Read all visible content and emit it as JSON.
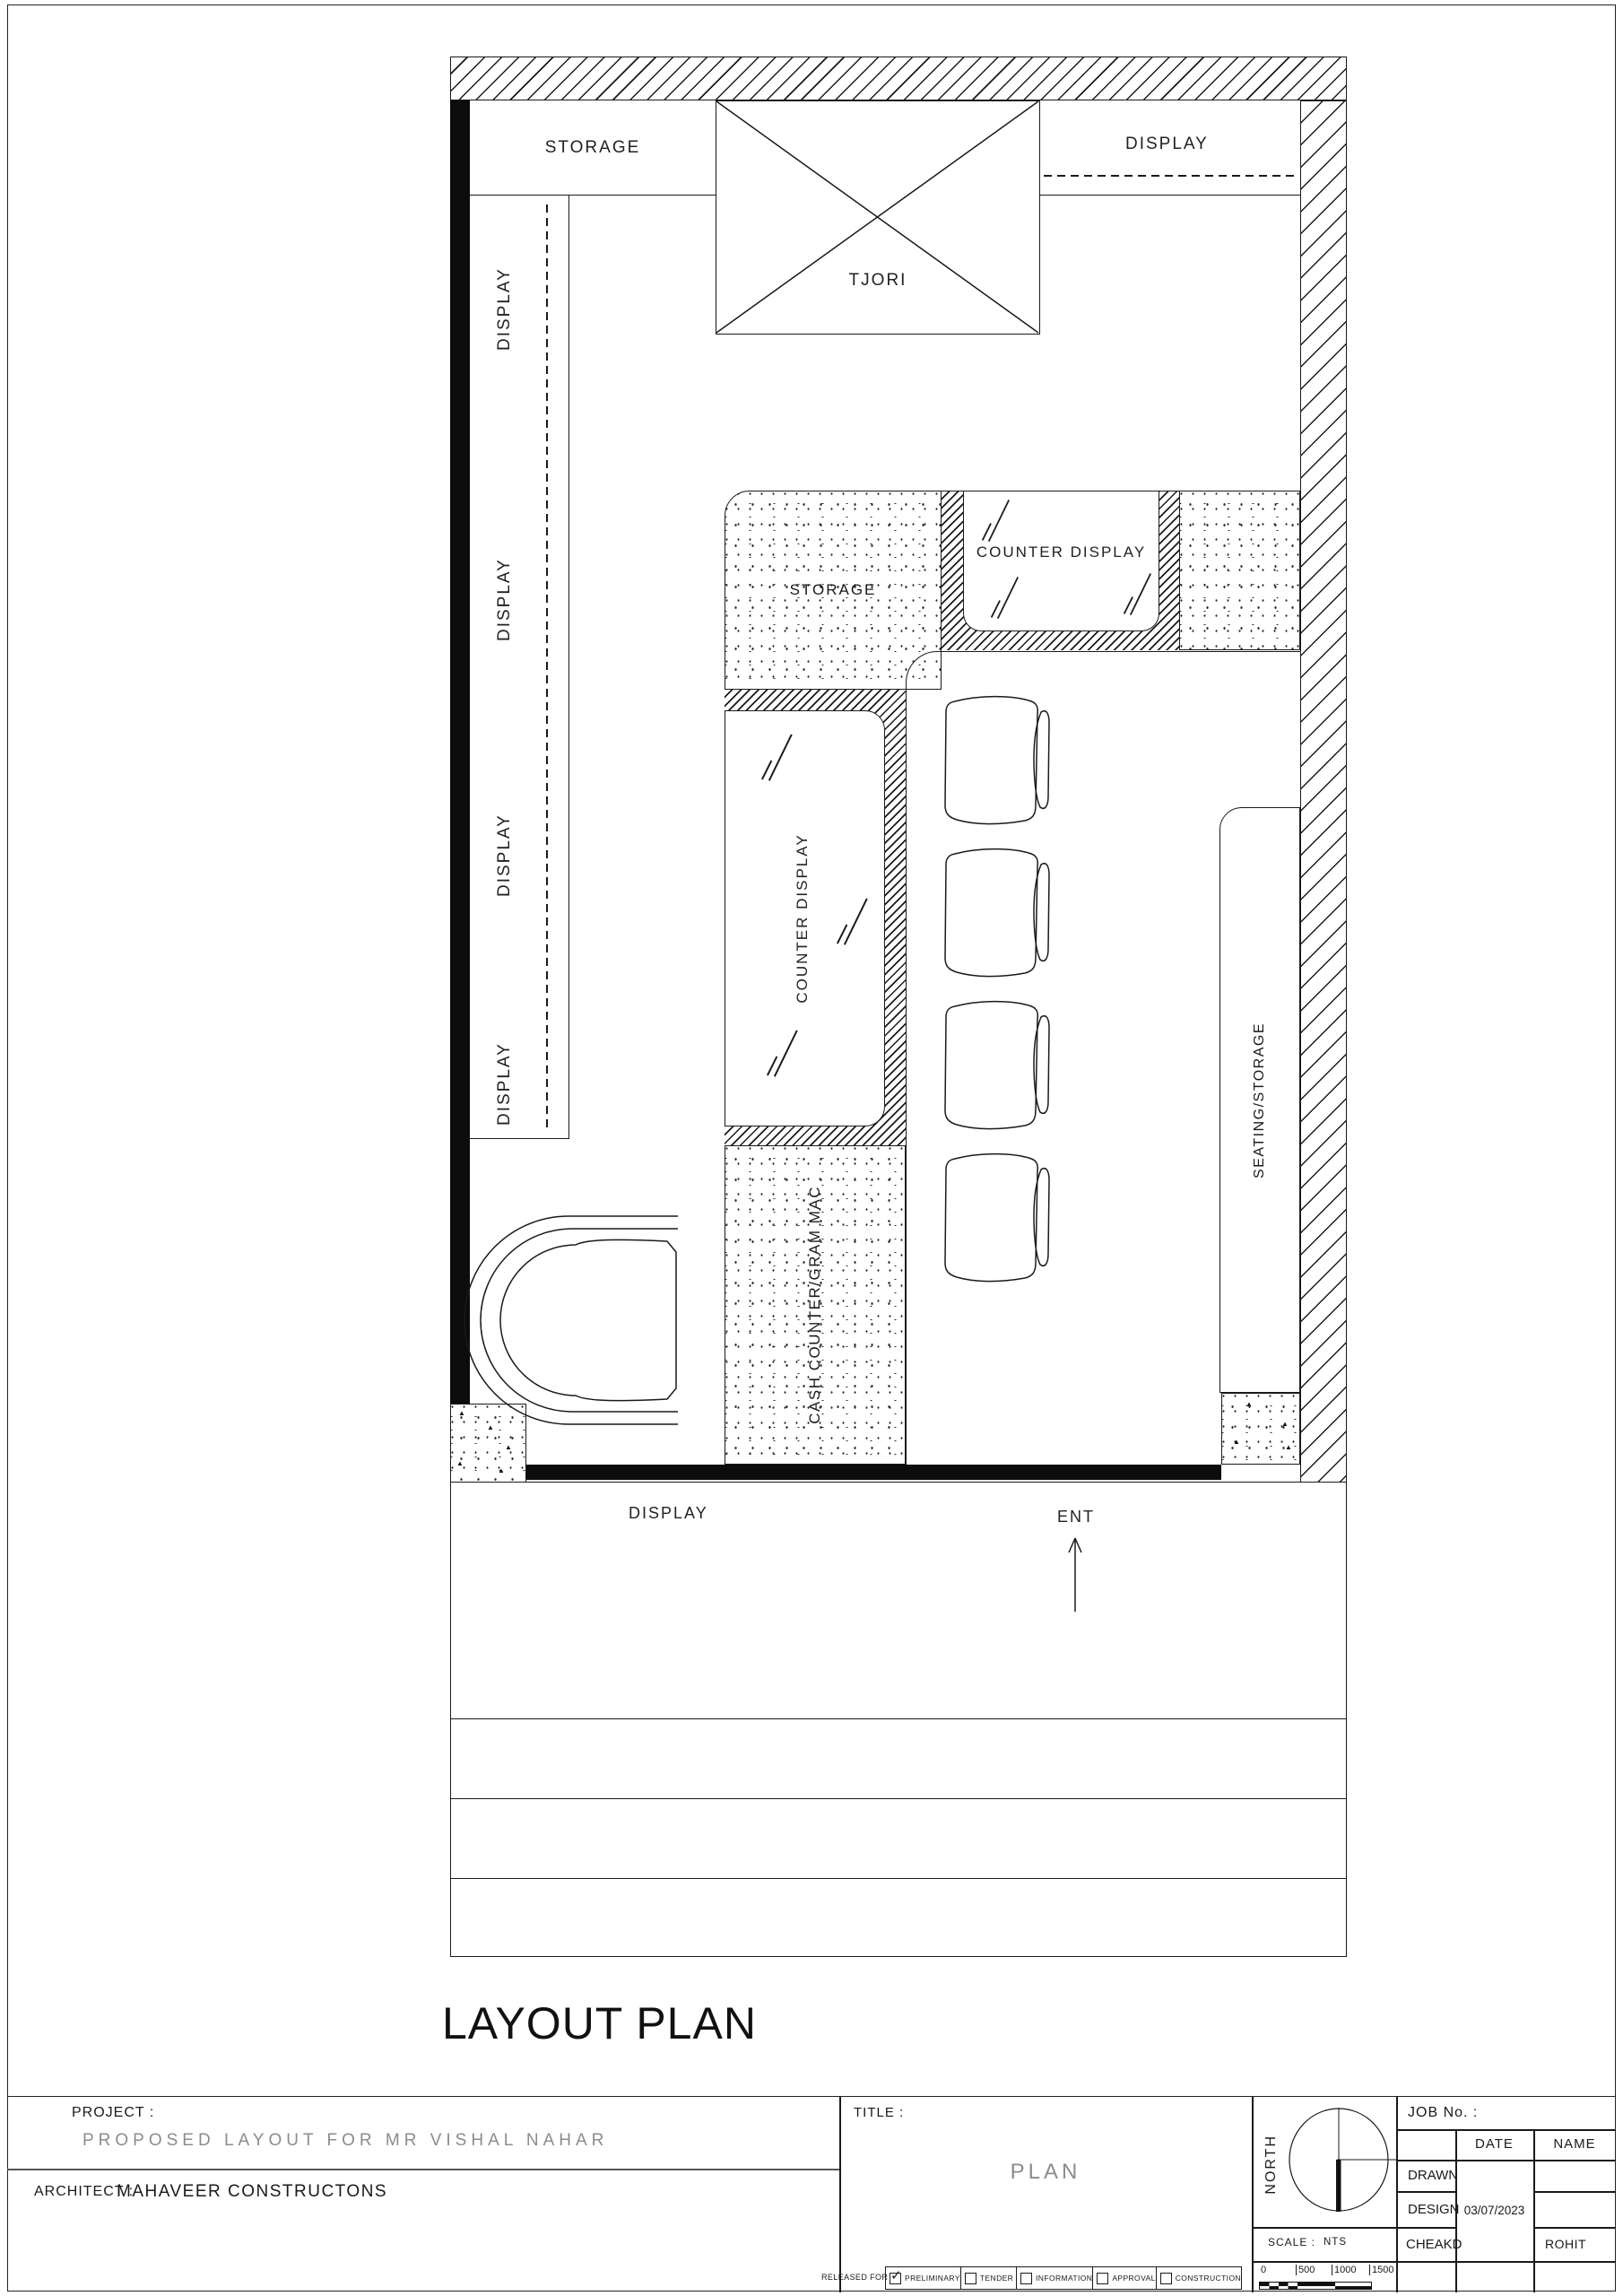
{
  "drawing": {
    "title": "LAYOUT PLAN",
    "plan": {
      "storage_top": "STORAGE",
      "display_top": "DISPLAY",
      "tjori": "TJORI",
      "wall_display_labels": [
        "DISPLAY",
        "DISPLAY",
        "DISPLAY",
        "DISPLAY"
      ],
      "storage_mid": "STORAGE",
      "counter_display_top": "COUNTER DISPLAY",
      "counter_display_mid": "COUNTER DISPLAY",
      "cash_counter": "CASH COUNTER/GRAM MAC",
      "seating_storage": "SEATING/STORAGE",
      "display_bottom": "DISPLAY",
      "entrance": "ENT"
    }
  },
  "titleblock": {
    "project_label": "PROJECT :",
    "project_value": "PROPOSED LAYOUT FOR MR VISHAL NAHAR",
    "architect_label": "ARCHITECT :",
    "architect_value": "MAHAVEER CONSTRUCTONS",
    "title_label": "TITLE :",
    "title_value": "PLAN",
    "released_for_label": "RELEASED FOR",
    "release_options": [
      {
        "label": "PRELIMINARY",
        "checked": true
      },
      {
        "label": "TENDER",
        "checked": false
      },
      {
        "label": "INFORMATION",
        "checked": false
      },
      {
        "label": "APPROVAL",
        "checked": false
      },
      {
        "label": "CONSTRUCTION",
        "checked": false
      }
    ],
    "north_label": "NORTH",
    "scale_label": "SCALE :",
    "scale_value": "NTS",
    "scalebar_ticks": [
      "0",
      "500",
      "1000",
      "1500"
    ],
    "job_no_label": "JOB No. :",
    "approval_table": {
      "date_header": "DATE",
      "name_header": "NAME",
      "rows": [
        {
          "label": "DRAWN",
          "date": "",
          "name": ""
        },
        {
          "label": "DESIGN",
          "date": "03/07/2023",
          "name": ""
        },
        {
          "label": "CHEAKD",
          "date": "",
          "name": "ROHIT"
        }
      ]
    }
  }
}
